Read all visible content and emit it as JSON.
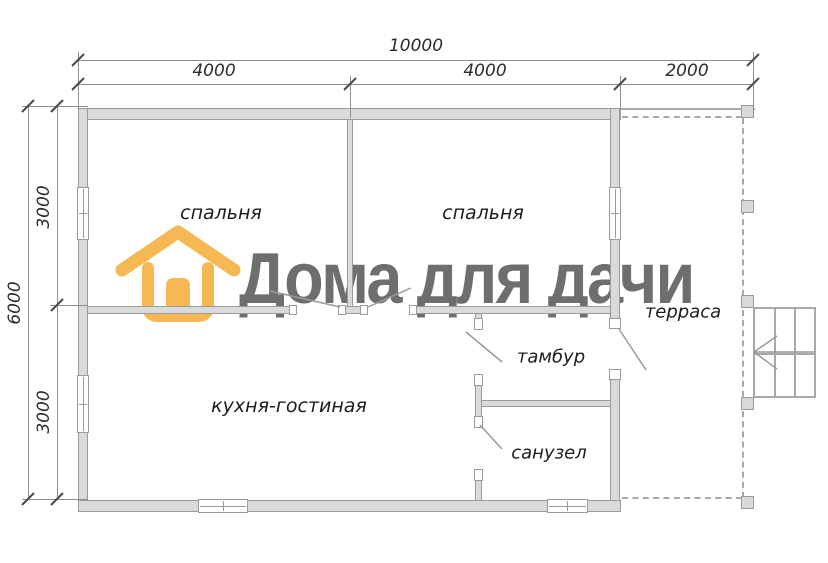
{
  "logo": {
    "brand_text": "Дома для дачи",
    "icon": "house-icon",
    "accent_color": "#F6B853",
    "text_color": "#6E6E6E"
  },
  "dimensions": {
    "top_total": "10000",
    "top_segments": [
      "4000",
      "4000",
      "2000"
    ],
    "left_total": "6000",
    "left_segments": [
      "3000",
      "3000"
    ]
  },
  "rooms": {
    "bedroom_1": "спальня",
    "bedroom_2": "спальня",
    "kitchen_living": "кухня-гостиная",
    "vestibule": "тамбур",
    "bathroom": "санузел",
    "terrace": "терраса"
  }
}
